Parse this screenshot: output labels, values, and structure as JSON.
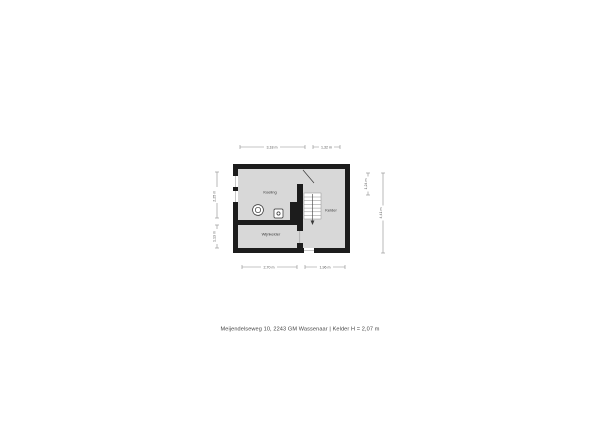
{
  "floorplan": {
    "caption": "Meijendelseweg 10, 2243 GM Wassenaar | Kelder H = 2,07 m",
    "rooms": {
      "koeling": "Koeling",
      "kelder": "Kelder",
      "wijnkelder": "Wijnkelder"
    },
    "dimensions": {
      "top_left": "3,18 m",
      "top_right": "1,32 m",
      "bottom_left": "2,70 m",
      "bottom_right": "1,96 m",
      "left_upper": "2,25 m",
      "left_lower": "1,13 m",
      "right_inner": "1,24 m",
      "right_outer": "4,41 m"
    },
    "icons": {
      "boiler": "boiler-icon",
      "sink": "sink-icon",
      "stairs": "stairs-icon",
      "door_swing": "door-swing-icon",
      "windows": "window-icon"
    },
    "colors": {
      "wall": "#1c1c1c",
      "floor": "#d8d8d8",
      "dimension_line": "#8a8a8a",
      "label_text": "#3a3a3a",
      "background": "#ffffff"
    }
  }
}
